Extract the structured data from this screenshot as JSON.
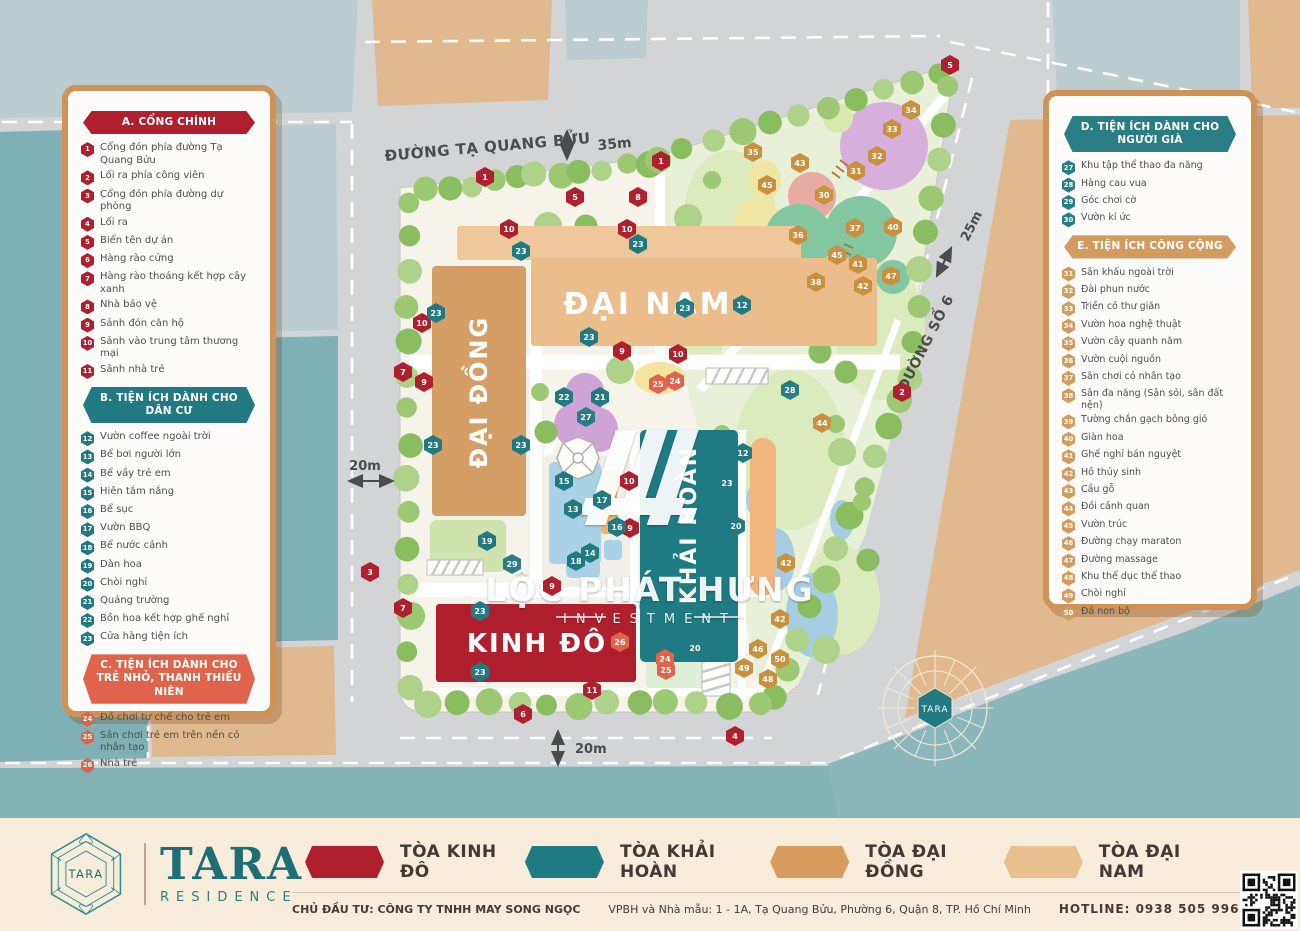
{
  "map": {
    "streets": {
      "ta_quang_buu": {
        "name": "ĐƯỜNG TẠ QUANG BỬU",
        "width_label": "35m"
      },
      "so_6": {
        "name": "ĐƯỜNG SỐ 6",
        "width_label": "25m"
      },
      "left_road_width": "20m",
      "bottom_road_width": "20m"
    },
    "buildings": [
      {
        "id": "dai-dong",
        "name": "ĐẠI ĐỒNG",
        "color": "#d59e66"
      },
      {
        "id": "dai-nam",
        "name": "ĐẠI NAM",
        "color": "#eabd8b"
      },
      {
        "id": "khai-hoan",
        "name": "KHẢI HOÀN",
        "color": "#1f7b83"
      },
      {
        "id": "kinh-do",
        "name": "KINH ĐÔ",
        "color": "#b01f2e"
      }
    ],
    "compass_label": "TARA",
    "watermark": {
      "line1": "LỘC PHÁT HƯNG",
      "line2": "INVESTMENT"
    },
    "marker_colors": {
      "a": "#b01f2e",
      "b": "#217a82",
      "c": "#e0634c",
      "d": "#2a7d84",
      "e": "#c9913f"
    },
    "markers": [
      [
        "1",
        "a",
        485,
        177
      ],
      [
        "5",
        "a",
        575,
        197
      ],
      [
        "8",
        "a",
        638,
        197
      ],
      [
        "1",
        "a",
        661,
        161
      ],
      [
        "5",
        "a",
        950,
        65
      ],
      [
        "2",
        "a",
        902,
        392
      ],
      [
        "3",
        "a",
        370,
        572
      ],
      [
        "7",
        "a",
        403,
        608
      ],
      [
        "7",
        "a",
        403,
        372
      ],
      [
        "9",
        "a",
        424,
        382
      ],
      [
        "10",
        "a",
        422,
        323
      ],
      [
        "10",
        "a",
        509,
        229
      ],
      [
        "10",
        "a",
        627,
        229
      ],
      [
        "9",
        "a",
        622,
        351
      ],
      [
        "10",
        "a",
        678,
        354
      ],
      [
        "10",
        "a",
        629,
        481
      ],
      [
        "9",
        "a",
        630,
        528
      ],
      [
        "9",
        "a",
        552,
        586
      ],
      [
        "11",
        "a",
        592,
        690
      ],
      [
        "6",
        "a",
        523,
        714
      ],
      [
        "4",
        "a",
        735,
        736
      ],
      [
        "23",
        "b",
        436,
        313
      ],
      [
        "23",
        "b",
        521,
        251
      ],
      [
        "23",
        "b",
        638,
        244
      ],
      [
        "23",
        "b",
        685,
        308
      ],
      [
        "12",
        "b",
        742,
        305
      ],
      [
        "23",
        "b",
        589,
        337
      ],
      [
        "22",
        "b",
        564,
        397
      ],
      [
        "21",
        "b",
        600,
        397
      ],
      [
        "27",
        "d",
        586,
        417
      ],
      [
        "23",
        "b",
        433,
        445
      ],
      [
        "23",
        "b",
        521,
        445
      ],
      [
        "15",
        "b",
        564,
        481
      ],
      [
        "17",
        "b",
        602,
        500
      ],
      [
        "13",
        "b",
        573,
        509
      ],
      [
        "16",
        "b",
        617,
        527
      ],
      [
        "14",
        "b",
        590,
        553
      ],
      [
        "18",
        "b",
        576,
        561
      ],
      [
        "23",
        "b",
        727,
        483
      ],
      [
        "12",
        "b",
        743,
        453
      ],
      [
        "20",
        "b",
        736,
        526
      ],
      [
        "20",
        "b",
        695,
        648
      ],
      [
        "19",
        "b",
        487,
        541
      ],
      [
        "23",
        "b",
        480,
        611
      ],
      [
        "23",
        "b",
        480,
        672
      ],
      [
        "29",
        "d",
        512,
        564
      ],
      [
        "28",
        "d",
        790,
        390
      ],
      [
        "24",
        "c",
        675,
        381
      ],
      [
        "25",
        "c",
        658,
        384
      ],
      [
        "26",
        "c",
        620,
        642
      ],
      [
        "24",
        "c",
        665,
        659
      ],
      [
        "25",
        "c",
        666,
        670
      ],
      [
        "34",
        "e",
        911,
        110
      ],
      [
        "33",
        "e",
        892,
        129
      ],
      [
        "32",
        "e",
        877,
        156
      ],
      [
        "35",
        "e",
        753,
        152
      ],
      [
        "43",
        "e",
        800,
        163
      ],
      [
        "31",
        "e",
        856,
        171
      ],
      [
        "45",
        "e",
        767,
        185
      ],
      [
        "30",
        "e",
        824,
        195
      ],
      [
        "36",
        "e",
        798,
        235
      ],
      [
        "37",
        "e",
        855,
        228
      ],
      [
        "40",
        "e",
        893,
        227
      ],
      [
        "45",
        "e",
        837,
        255
      ],
      [
        "41",
        "e",
        858,
        264
      ],
      [
        "38",
        "e",
        816,
        282
      ],
      [
        "47",
        "e",
        891,
        276
      ],
      [
        "42",
        "e",
        863,
        286
      ],
      [
        "44",
        "e",
        822,
        423
      ],
      [
        "42",
        "e",
        786,
        563
      ],
      [
        "42",
        "e",
        780,
        619
      ],
      [
        "46",
        "e",
        758,
        649
      ],
      [
        "50",
        "e",
        780,
        659
      ],
      [
        "48",
        "e",
        768,
        679
      ],
      [
        "49",
        "e",
        744,
        668
      ]
    ]
  },
  "legend_left": {
    "sections": [
      {
        "id": "A",
        "title": "A. CỔNG CHÍNH",
        "color": "#b01f2e",
        "items": [
          {
            "n": "1",
            "label": "Cổng đón phía đường Tạ Quang Bửu"
          },
          {
            "n": "2",
            "label": "Lối ra phía công viên"
          },
          {
            "n": "3",
            "label": "Cổng đón phía đường dự phòng"
          },
          {
            "n": "4",
            "label": "Lối ra"
          },
          {
            "n": "5",
            "label": "Biển tên dự án"
          },
          {
            "n": "6",
            "label": "Hàng rào cứng"
          },
          {
            "n": "7",
            "label": "Hàng rào thoáng kết hợp cây xanh"
          },
          {
            "n": "8",
            "label": "Nhà bảo vệ"
          },
          {
            "n": "9",
            "label": "Sảnh đón căn hộ"
          },
          {
            "n": "10",
            "label": "Sảnh vào trung tâm thương mại"
          },
          {
            "n": "11",
            "label": "Sảnh nhà trẻ"
          }
        ]
      },
      {
        "id": "B",
        "title": "B. TIỆN ÍCH DÀNH CHO DÂN CƯ",
        "color": "#217a82",
        "items": [
          {
            "n": "12",
            "label": "Vườn coffee ngoài trời"
          },
          {
            "n": "13",
            "label": "Bể bơi người lớn"
          },
          {
            "n": "14",
            "label": "Bể vầy trẻ em"
          },
          {
            "n": "15",
            "label": "Hiên tắm nắng"
          },
          {
            "n": "16",
            "label": "Bể sục"
          },
          {
            "n": "17",
            "label": "Vườn BBQ"
          },
          {
            "n": "18",
            "label": "Bể nước cảnh"
          },
          {
            "n": "19",
            "label": "Dàn hoa"
          },
          {
            "n": "20",
            "label": "Chòi nghỉ"
          },
          {
            "n": "21",
            "label": "Quảng trường"
          },
          {
            "n": "22",
            "label": "Bồn hoa kết hợp ghế nghỉ"
          },
          {
            "n": "23",
            "label": "Cửa hàng tiện ích"
          }
        ]
      },
      {
        "id": "C",
        "title": "C. TIỆN ÍCH DÀNH CHO TRẺ NHỎ, THANH THIẾU NIÊN",
        "color": "#e0634c",
        "items": [
          {
            "n": "24",
            "label": "Đồ chơi tự chế cho trẻ em"
          },
          {
            "n": "25",
            "label": "Sân chơi trẻ em trên nền cỏ nhân tạo"
          },
          {
            "n": "26",
            "label": "Nhà trẻ"
          }
        ]
      }
    ]
  },
  "legend_right": {
    "sections": [
      {
        "id": "D",
        "title": "D. TIỆN ÍCH DÀNH CHO NGƯỜI GIÀ",
        "color": "#2a7d84",
        "items": [
          {
            "n": "27",
            "label": "Khu tập thể thao đa năng"
          },
          {
            "n": "28",
            "label": "Hàng cau vua"
          },
          {
            "n": "29",
            "label": "Góc chơi cờ"
          },
          {
            "n": "30",
            "label": "Vườn kí ức"
          }
        ]
      },
      {
        "id": "E",
        "title": "E. TIỆN ÍCH CÔNG CỘNG",
        "color": "#d29b5f",
        "items": [
          {
            "n": "31",
            "label": "Sân khấu ngoài trời"
          },
          {
            "n": "32",
            "label": "Đài phun nước"
          },
          {
            "n": "33",
            "label": "Triền cỏ thư giãn"
          },
          {
            "n": "34",
            "label": "Vườn hoa nghệ thuật"
          },
          {
            "n": "35",
            "label": "Vườn cây quanh năm"
          },
          {
            "n": "36",
            "label": "Vườn cuội nguồn"
          },
          {
            "n": "37",
            "label": "Sân chơi cỏ nhân tạo"
          },
          {
            "n": "38",
            "label": "Sân đa năng (Sân sỏi, sân đất nện)"
          },
          {
            "n": "39",
            "label": "Tường chắn gạch bông gió"
          },
          {
            "n": "40",
            "label": "Giàn hoa"
          },
          {
            "n": "41",
            "label": "Ghế nghỉ bán nguyệt"
          },
          {
            "n": "42",
            "label": "Hồ thủy sinh"
          },
          {
            "n": "43",
            "label": "Cầu gỗ"
          },
          {
            "n": "44",
            "label": "Đồi cảnh quan"
          },
          {
            "n": "45",
            "label": "Vườn trúc"
          },
          {
            "n": "46",
            "label": "Đường chạy maraton"
          },
          {
            "n": "47",
            "label": "Đường massage"
          },
          {
            "n": "48",
            "label": "Khu thể dục thể thao"
          },
          {
            "n": "49",
            "label": "Chòi nghỉ"
          },
          {
            "n": "50",
            "label": "Đá non bộ"
          }
        ]
      }
    ]
  },
  "footer": {
    "brand": {
      "logo_text": "TARA",
      "name": "TARA",
      "subtitle": "RESIDENCE"
    },
    "towers": [
      {
        "label": "TÒA KINH ĐÔ",
        "color": "#b01f2e"
      },
      {
        "label": "TÒA KHẢI HOÀN",
        "color": "#1f7b83"
      },
      {
        "label": "TÒA ĐẠI ĐỒNG",
        "color": "#d79c5e"
      },
      {
        "label": "TÒA ĐẠI NAM",
        "color": "#e9c08f"
      }
    ],
    "developer": "CHỦ ĐẦU TƯ: CÔNG TY TNHH MAY SONG NGỌC",
    "office": "VPBH và Nhà mẫu: 1 - 1A, Tạ Quang Bửu, Phường 6, Quận 8, TP. Hồ Chí Minh",
    "hotline": "HOTLINE: 0938 505 996"
  }
}
